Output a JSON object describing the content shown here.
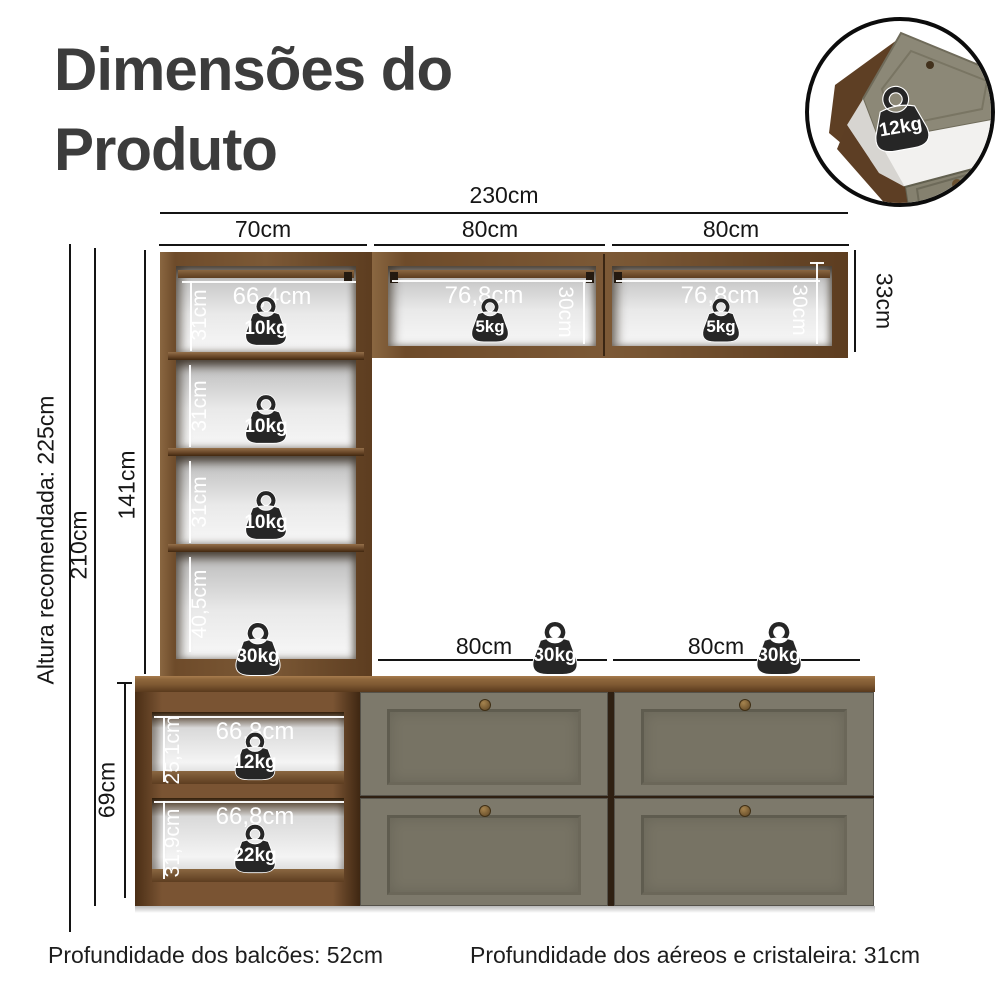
{
  "title": {
    "line1": "Dimensões do",
    "line2": "Produto"
  },
  "top_dims": {
    "total": "230cm",
    "col1": "70cm",
    "col2": "80cm",
    "col3": "80cm"
  },
  "side_dims": {
    "recommended_height": "Altura recomendada: 225cm",
    "overall_height": "210cm",
    "hutch_height": "141cm",
    "base_height": "69cm",
    "aerial_height": "33cm"
  },
  "counter_dims": {
    "mid_width": "80cm",
    "right_width": "80cm"
  },
  "hutch": {
    "top_shelf": {
      "width": "66,4cm",
      "height": "31cm",
      "capacity": "10kg"
    },
    "shelf2": {
      "height": "31cm",
      "capacity": "10kg"
    },
    "shelf3": {
      "height": "31cm",
      "capacity": "10kg"
    },
    "shelf4": {
      "height": "40,5cm",
      "capacity": "30kg"
    }
  },
  "aerial": {
    "mid": {
      "width": "76,8cm",
      "height": "30cm",
      "capacity": "5kg"
    },
    "right": {
      "width": "76,8cm",
      "height": "30cm",
      "capacity": "5kg"
    }
  },
  "counter": {
    "mid_capacity": "30kg",
    "right_capacity": "30kg"
  },
  "base": {
    "open_top": {
      "width": "66,8cm",
      "height": "25,1cm",
      "capacity": "12kg"
    },
    "open_bottom": {
      "width": "66,8cm",
      "height": "31,9cm",
      "capacity": "22kg"
    }
  },
  "inset": {
    "capacity": "12kg"
  },
  "footer": {
    "counters_depth": "Profundidade dos balcões: 52cm",
    "aerials_depth": "Profundidade dos aéreos e cristaleira: 31cm"
  },
  "colors": {
    "wood": "#75512f",
    "wood_dark": "#4e3018",
    "counter_top": "#8f673c",
    "drawer_front": "#7d796b",
    "weight": "#262626",
    "dim_text": "#161616"
  }
}
